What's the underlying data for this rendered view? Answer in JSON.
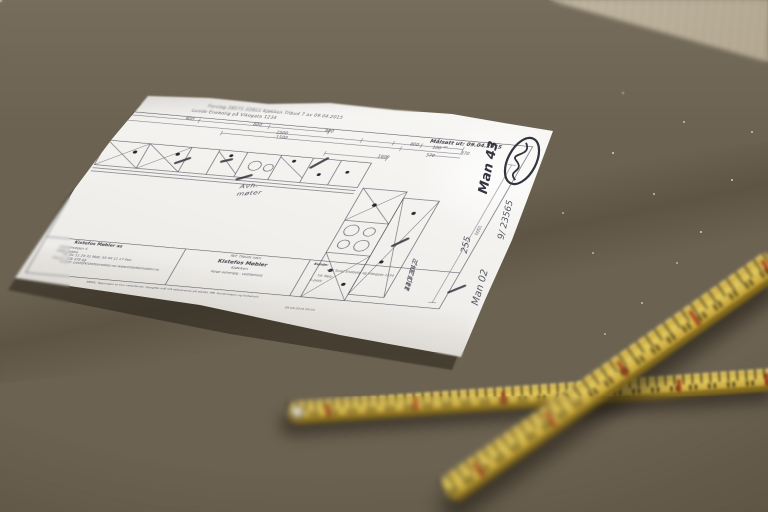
{
  "photo": {
    "colors": {
      "wood_base": "#6c6251",
      "wood_dark": "#4d4335",
      "wood_light": "#847a67",
      "pale_plank": "#c9beab",
      "paper": "#f2f0ed",
      "print_ink": "#50515b",
      "pencil": "#4a4a55",
      "ruler_yellow": "#d2b143",
      "ruler_shade": "#977b21",
      "ruler_red_mark": "#982c18"
    },
    "paper": {
      "header_line1": "Forslag 28171 22811  Kjøkken  Tilbud 7 av 09.04.2015",
      "header_line2": "Lunde Enebolig på Vikegata 1234",
      "date_stamp": "Målsatt ut: 09.04.2015",
      "dimensions": {
        "row1": [
          "900",
          "600",
          "900"
        ],
        "row2": [
          "2500",
          "800",
          "100",
          "870"
        ],
        "sup90": "90",
        "row3": [
          "1500",
          "570"
        ],
        "run": "1600",
        "side": "1500"
      },
      "plan_note_1": "Avh.",
      "plan_note_2": "møter",
      "title_block": {
        "company": "Kistefos Møbler as",
        "company_line1": "Industrivegen 4",
        "company_line2": "2880 Dokka",
        "company_line3": "Tlf: 61 11 29 32  Mob: 95 94 11 17  Fax:",
        "company_line4": "Org.nr: 978 478 04",
        "company_line5": "E-post: post@kistefosmobler.no  www.kistefosmobler.no",
        "ref_label": "Ref: Tilbuds navn",
        "customer": "Kistefos Møbler",
        "project": "Kjøkken",
        "project_line": "Farge avhengig - vedlikehold",
        "kunde_label": "Kunde:",
        "kunde_line1": "Ved Tunet Enebolig og Vikegata 1234",
        "kunde_line2": "Tlf:        Mob:",
        "kunde_line3": "E-post:",
        "disclaimer": "MERK: Tegningen er kun veiledende. Oppgitte mål må etterprøves på stedet. MB. Konstruksjon og forbehold.",
        "print_stamp": "09.04.2015 09:51"
      },
      "handwriting": {
        "note_top": "Man 43",
        "note_mid1": "9/ 23565",
        "note_mid2": "255",
        "note_low": "Man 02",
        "calc_line1": "24,7  34,2",
        "calc_line2": "120  20",
        "calc_line3": "41,5  242"
      }
    }
  }
}
